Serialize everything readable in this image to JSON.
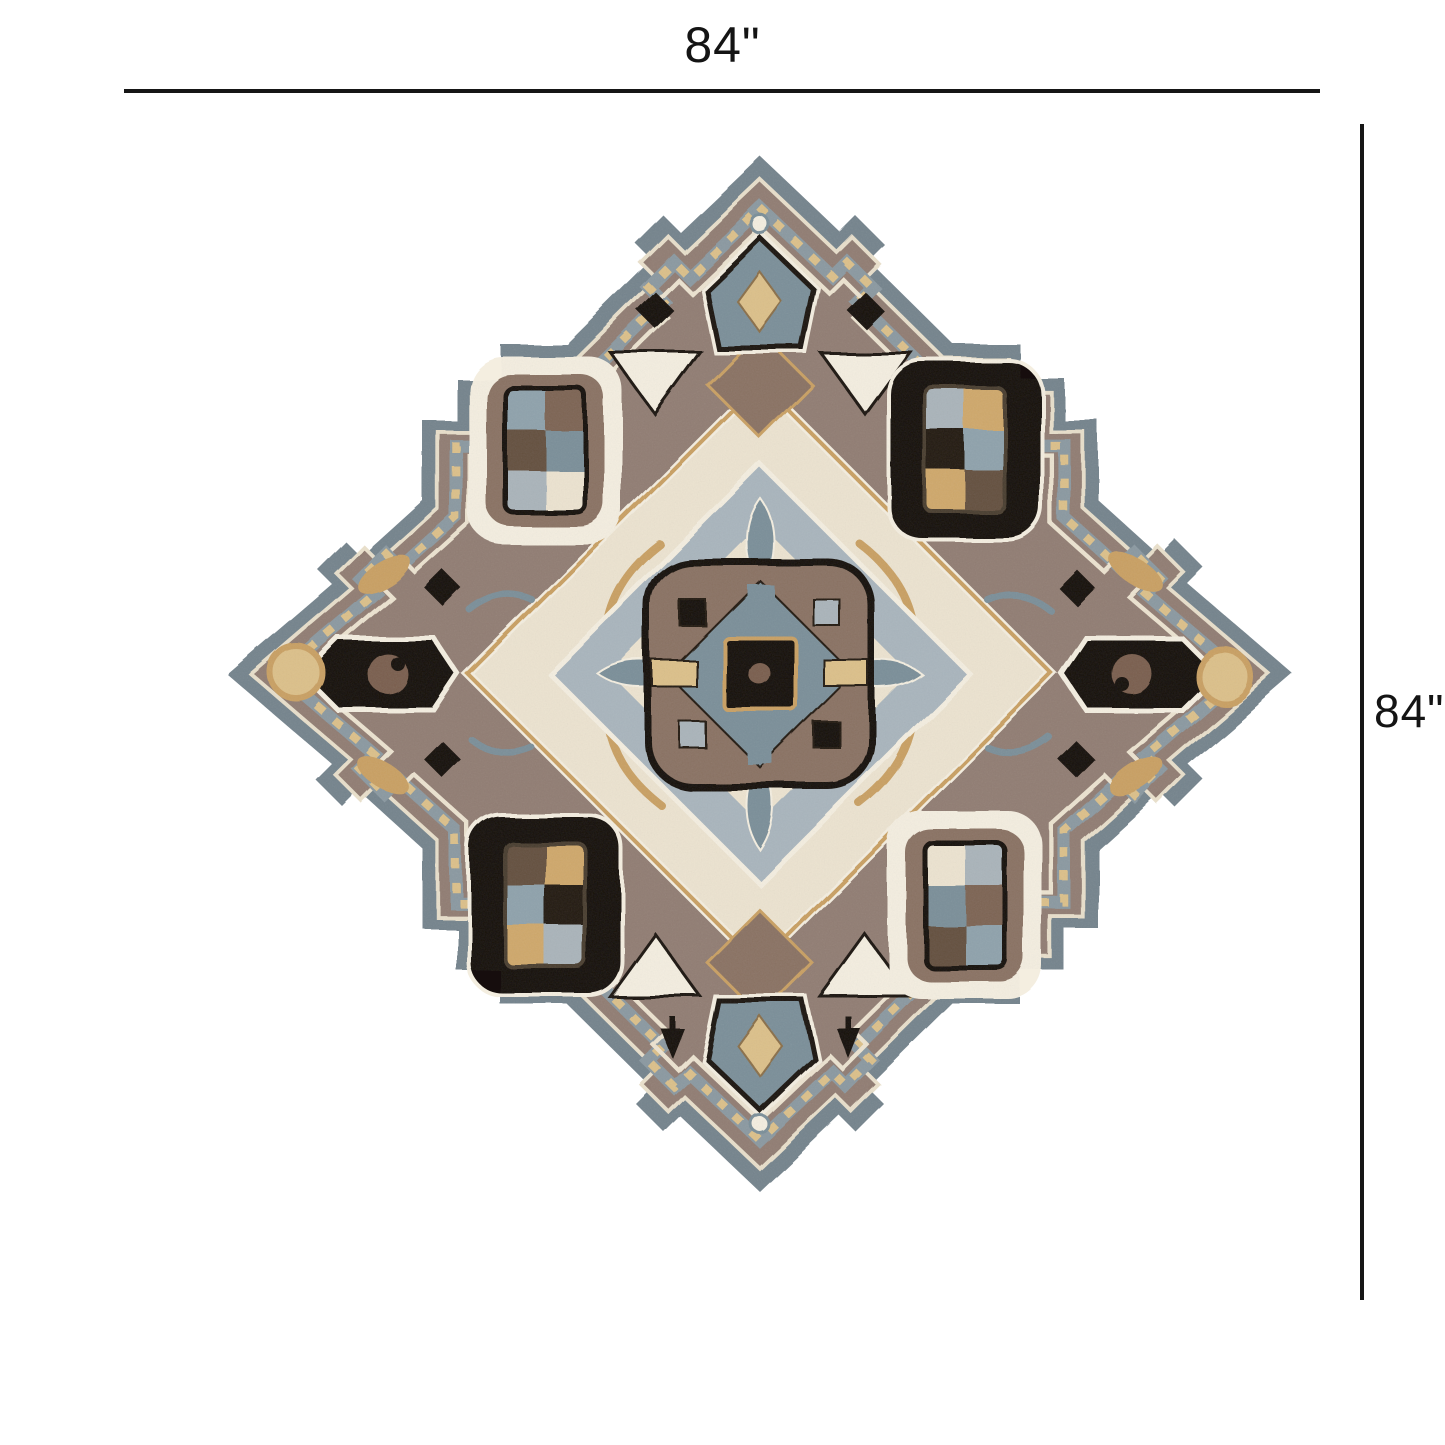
{
  "page": {
    "background": "#ffffff"
  },
  "dimensions": {
    "width_label": "84\"",
    "height_label": "84\""
  },
  "rug": {
    "description": "Ornate hand-tufted octagram medallion area rug in slate blue, taupe, cream, tan and black",
    "palette": {
      "slate": "#75848d",
      "slateLight": "#8b99a1",
      "field": "#917d73",
      "medallion": "#8a7263",
      "cream": "#ece3d0",
      "ivory": "#f4eee0",
      "gold": "#c9a063",
      "goldLight": "#dcc08a",
      "tan": "#cfa86b",
      "steel": "#7b8f99",
      "blue": "#8fa2ac",
      "bluegray": "#a9b5bd",
      "gray": "#aab4ba",
      "black": "#17110b",
      "black2": "#241b12",
      "brown2": "#7d6454",
      "brown3": "#64503f",
      "spiral": "#7a5f4e",
      "ink": "#141414"
    }
  }
}
